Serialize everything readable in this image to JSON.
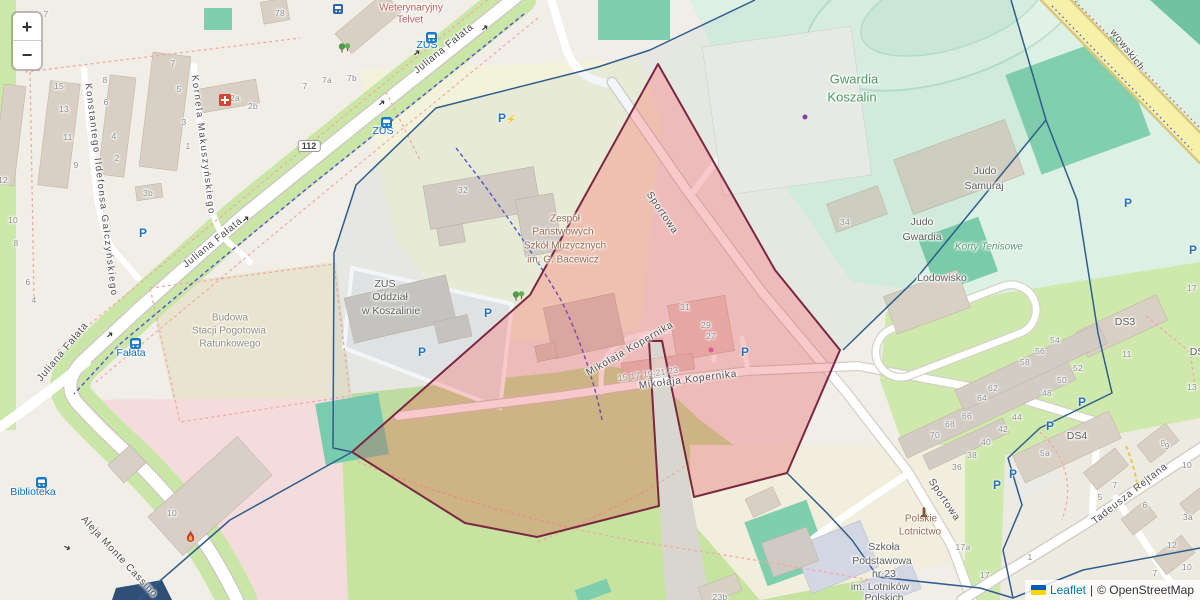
{
  "controls": {
    "zoom_in_label": "+",
    "zoom_out_label": "−"
  },
  "attribution": {
    "leaflet_label": "Leaflet",
    "separator": "|",
    "osm_label": "© OpenStreetMap",
    "leaflet_link_color": "#0078A8",
    "flag_top_color": "#005BBB",
    "flag_bottom_color": "#FFD500"
  },
  "overlay": {
    "red_fill": "rgba(227,54,62,0.27)",
    "red_stroke": "#7c2742",
    "blue_stroke": "#2f5d8c",
    "tint_a_fill": "rgba(100,140,175,0.08)",
    "tint_b_fill": "rgba(110,185,160,0.10)",
    "red_polygon": "658,64 775,270 840,350 787,473 694,497 662,341 649,341 659,506 537,537 465,523 352,452 530,295",
    "tint_a_polygon": "755,0 650,50 598,67 436,108 356,185 334,253 333,448 352,452 530,295 658,64",
    "tint_b_polygon": "755,0 1011,0 1046,120 915,280 843,350 840,350 775,270 658,64",
    "blue_lines": [
      "755,0 650,50 598,67 436,108 356,185 334,253 333,448 352,452",
      "352,452 230,520 138,600",
      "1011,0 1046,120 915,280 843,350",
      "1046,120 1077,200 1098,333 1112,393 1040,428 1008,458 1022,505 1003,550 1013,598",
      "787,473 827,513 852,540 878,577 980,588 1013,598",
      "1013,598 1083,570 1200,548"
    ]
  },
  "road_shield": {
    "label": "112",
    "x": 309,
    "y": 146
  },
  "streets": [
    {
      "label": "Juliana Fałata",
      "x": 444,
      "y": 49,
      "rot": -39,
      "cls": "street"
    },
    {
      "label": "Juliana Fałata",
      "x": 213,
      "y": 243,
      "rot": -39,
      "cls": "street"
    },
    {
      "label": "Juliana Fałata",
      "x": 63,
      "y": 352,
      "rot": -50,
      "cls": "street"
    },
    {
      "label": "Konstantego Ildefonsa Gałczyńskiego",
      "x": 101,
      "y": 190,
      "rot": 83,
      "cls": "street-v"
    },
    {
      "label": "Kornela Makuszyńskiego",
      "x": 203,
      "y": 145,
      "rot": 83,
      "cls": "street-v"
    },
    {
      "label": "Aleja Monte Cassino",
      "x": 119,
      "y": 557,
      "rot": 47,
      "cls": "street"
    },
    {
      "label": "Sportowa",
      "x": 662,
      "y": 213,
      "rot": 56,
      "cls": "street"
    },
    {
      "label": "Sportowa",
      "x": 944,
      "y": 500,
      "rot": 56,
      "cls": "street"
    },
    {
      "label": "Mikołaja Kopernika",
      "x": 630,
      "y": 349,
      "rot": -30,
      "cls": "street"
    },
    {
      "label": "Mikołaja Kopernika",
      "x": 688,
      "y": 380,
      "rot": -7,
      "cls": "street"
    },
    {
      "label": "Tadeusza Rejtana",
      "x": 1130,
      "y": 494,
      "rot": -38,
      "cls": "street"
    },
    {
      "label": "wowskich",
      "x": 1127,
      "y": 50,
      "rot": 52,
      "cls": "street"
    }
  ],
  "pois": [
    {
      "label": "Weterynaryjny",
      "x": 411,
      "y": 8,
      "cls": "vet"
    },
    {
      "label": "Telvet",
      "x": 410,
      "y": 20,
      "cls": "vet"
    },
    {
      "label": "ZUS",
      "x": 427,
      "y": 45,
      "cls": "transit"
    },
    {
      "label": "ZUS",
      "x": 383,
      "y": 131,
      "cls": "transit"
    },
    {
      "label": "Fałata",
      "x": 131,
      "y": 353,
      "cls": "transit"
    },
    {
      "label": "Biblioteka",
      "x": 33,
      "y": 492,
      "cls": "transit"
    },
    {
      "label": "ZUS",
      "x": 385,
      "y": 284,
      "cls": "poi"
    },
    {
      "label": "Oddział",
      "x": 390,
      "y": 297,
      "cls": "poi"
    },
    {
      "label": "w Koszalinie",
      "x": 391,
      "y": 311,
      "cls": "poi"
    },
    {
      "label": "Zespół",
      "x": 565,
      "y": 219,
      "cls": "school"
    },
    {
      "label": "Państwowych",
      "x": 563,
      "y": 232,
      "cls": "school"
    },
    {
      "label": "Szkół Muzycznych",
      "x": 565,
      "y": 246,
      "cls": "school"
    },
    {
      "label": "im. G. Bacewicz",
      "x": 563,
      "y": 260,
      "cls": "school"
    },
    {
      "label": "Budowa",
      "x": 230,
      "y": 318,
      "cls": "constr"
    },
    {
      "label": "Stacji Pogotowia",
      "x": 229,
      "y": 331,
      "cls": "constr"
    },
    {
      "label": "Ratunkowego",
      "x": 230,
      "y": 344,
      "cls": "constr"
    },
    {
      "label": "Gwardia",
      "x": 854,
      "y": 79,
      "cls": "stadium"
    },
    {
      "label": "Koszalin",
      "x": 852,
      "y": 97,
      "cls": "stadium"
    },
    {
      "label": "Judo",
      "x": 985,
      "y": 171,
      "cls": "poi"
    },
    {
      "label": "Samuraj",
      "x": 984,
      "y": 186,
      "cls": "poi"
    },
    {
      "label": "Judo",
      "x": 922,
      "y": 222,
      "cls": "poi"
    },
    {
      "label": "Gwardia",
      "x": 922,
      "y": 237,
      "cls": "poi"
    },
    {
      "label": "Korty Tenisowe",
      "x": 989,
      "y": 247,
      "cls": "pitchlbl"
    },
    {
      "label": "Lodowisko",
      "x": 942,
      "y": 278,
      "cls": "poi"
    },
    {
      "label": "DS3",
      "x": 1125,
      "y": 322,
      "cls": "poi"
    },
    {
      "label": "DS4",
      "x": 1077,
      "y": 436,
      "cls": "poi"
    },
    {
      "label": "DS2",
      "x": 1200,
      "y": 352,
      "cls": "poi"
    },
    {
      "label": "Szkoła",
      "x": 884,
      "y": 547,
      "cls": "poi"
    },
    {
      "label": "Podstawowa",
      "x": 882,
      "y": 561,
      "cls": "poi"
    },
    {
      "label": "nr 23",
      "x": 884,
      "y": 574,
      "cls": "poi"
    },
    {
      "label": "im. Lotników",
      "x": 880,
      "y": 587,
      "cls": "poi"
    },
    {
      "label": "Polskich",
      "x": 884,
      "y": 598,
      "cls": "poi"
    },
    {
      "label": "Polskie",
      "x": 921,
      "y": 519,
      "cls": "school"
    },
    {
      "label": "Lotnictwo",
      "x": 920,
      "y": 532,
      "cls": "school"
    }
  ],
  "numbers": [
    {
      "label": "7",
      "x": 46,
      "y": 14
    },
    {
      "label": "78",
      "x": 280,
      "y": 13
    },
    {
      "label": "15",
      "x": 59,
      "y": 86
    },
    {
      "label": "13",
      "x": 64,
      "y": 109
    },
    {
      "label": "11",
      "x": 68,
      "y": 137
    },
    {
      "label": "9",
      "x": 76,
      "y": 165
    },
    {
      "label": "8",
      "x": 105,
      "y": 80
    },
    {
      "label": "6",
      "x": 106,
      "y": 102
    },
    {
      "label": "4",
      "x": 114,
      "y": 136
    },
    {
      "label": "2",
      "x": 117,
      "y": 158
    },
    {
      "label": "7",
      "x": 173,
      "y": 63
    },
    {
      "label": "5",
      "x": 179,
      "y": 89
    },
    {
      "label": "3",
      "x": 184,
      "y": 122
    },
    {
      "label": "1",
      "x": 188,
      "y": 146
    },
    {
      "label": "2a",
      "x": 235,
      "y": 98
    },
    {
      "label": "2b",
      "x": 253,
      "y": 106
    },
    {
      "label": "3b",
      "x": 148,
      "y": 193
    },
    {
      "label": "7",
      "x": 305,
      "y": 86
    },
    {
      "label": "7a",
      "x": 327,
      "y": 80
    },
    {
      "label": "7b",
      "x": 352,
      "y": 78
    },
    {
      "label": "12",
      "x": 3,
      "y": 180
    },
    {
      "label": "10",
      "x": 13,
      "y": 220
    },
    {
      "label": "8",
      "x": 16,
      "y": 243
    },
    {
      "label": "6",
      "x": 28,
      "y": 282
    },
    {
      "label": "4",
      "x": 34,
      "y": 300
    },
    {
      "label": "32",
      "x": 463,
      "y": 190
    },
    {
      "label": "34",
      "x": 845,
      "y": 222
    },
    {
      "label": "31",
      "x": 685,
      "y": 307
    },
    {
      "label": "29",
      "x": 706,
      "y": 325
    },
    {
      "label": "27",
      "x": 711,
      "y": 336
    },
    {
      "label": "15 17 19 21 23",
      "x": 648,
      "y": 374,
      "rot": -8
    },
    {
      "label": "10",
      "x": 172,
      "y": 513
    },
    {
      "label": "17",
      "x": 1192,
      "y": 288
    },
    {
      "label": "11",
      "x": 1127,
      "y": 354
    },
    {
      "label": "13",
      "x": 1192,
      "y": 387
    },
    {
      "label": "54",
      "x": 1055,
      "y": 340
    },
    {
      "label": "56",
      "x": 1040,
      "y": 351
    },
    {
      "label": "58",
      "x": 1025,
      "y": 362
    },
    {
      "label": "52",
      "x": 1078,
      "y": 368
    },
    {
      "label": "50",
      "x": 1062,
      "y": 380
    },
    {
      "label": "62",
      "x": 993,
      "y": 388
    },
    {
      "label": "48",
      "x": 1047,
      "y": 393
    },
    {
      "label": "64",
      "x": 982,
      "y": 398
    },
    {
      "label": "44",
      "x": 1017,
      "y": 417
    },
    {
      "label": "66",
      "x": 967,
      "y": 416
    },
    {
      "label": "42",
      "x": 1003,
      "y": 429
    },
    {
      "label": "68",
      "x": 950,
      "y": 424
    },
    {
      "label": "40",
      "x": 986,
      "y": 442
    },
    {
      "label": "70",
      "x": 935,
      "y": 435
    },
    {
      "label": "38",
      "x": 972,
      "y": 455
    },
    {
      "label": "36",
      "x": 957,
      "y": 467
    },
    {
      "label": "5a",
      "x": 1045,
      "y": 453
    },
    {
      "label": "3a",
      "x": 1188,
      "y": 517
    },
    {
      "label": "1",
      "x": 1030,
      "y": 557
    },
    {
      "label": "17a",
      "x": 963,
      "y": 547
    },
    {
      "label": "17",
      "x": 985,
      "y": 575
    },
    {
      "label": "23b",
      "x": 720,
      "y": 597
    },
    {
      "label": "9",
      "x": 1163,
      "y": 443
    },
    {
      "label": "10",
      "x": 1187,
      "y": 465
    },
    {
      "label": "5",
      "x": 1100,
      "y": 497
    },
    {
      "label": "7",
      "x": 1115,
      "y": 485
    },
    {
      "label": "6",
      "x": 1145,
      "y": 505
    },
    {
      "label": "12",
      "x": 1172,
      "y": 545
    },
    {
      "label": "10",
      "x": 1187,
      "y": 567
    },
    {
      "label": "7",
      "x": 1155,
      "y": 573
    },
    {
      "label": "9",
      "x": 1167,
      "y": 446
    }
  ],
  "icons": [
    {
      "type": "bus-stop",
      "x": 426,
      "y": 32
    },
    {
      "type": "bus-stop",
      "x": 381,
      "y": 117
    },
    {
      "type": "bus-stop",
      "x": 130,
      "y": 338
    },
    {
      "type": "bus-stop",
      "x": 36,
      "y": 477
    },
    {
      "type": "rail",
      "x": 333,
      "y": 4
    },
    {
      "type": "parking",
      "x": 143,
      "y": 233
    },
    {
      "type": "parking",
      "x": 488,
      "y": 313
    },
    {
      "type": "parking",
      "x": 422,
      "y": 352
    },
    {
      "type": "parking",
      "x": 745,
      "y": 352
    },
    {
      "type": "parking",
      "x": 1128,
      "y": 203
    },
    {
      "type": "parking",
      "x": 1193,
      "y": 250
    },
    {
      "type": "parking",
      "x": 1082,
      "y": 402
    },
    {
      "type": "parking",
      "x": 1050,
      "y": 426
    },
    {
      "type": "parking",
      "x": 1013,
      "y": 474
    },
    {
      "type": "parking",
      "x": 997,
      "y": 485
    },
    {
      "type": "parking-ev",
      "x": 507,
      "y": 118
    },
    {
      "type": "medical-cross",
      "x": 219,
      "y": 94
    },
    {
      "type": "flame",
      "x": 185,
      "y": 530
    },
    {
      "type": "monument",
      "x": 919,
      "y": 507
    },
    {
      "type": "dot-purple",
      "x": 805,
      "y": 117
    },
    {
      "type": "dot-pink",
      "x": 711,
      "y": 350
    },
    {
      "type": "trees",
      "x": 338,
      "y": 42
    },
    {
      "type": "trees",
      "x": 512,
      "y": 290
    },
    {
      "type": "arrow",
      "x": 485,
      "y": 28,
      "rot": -39
    },
    {
      "type": "arrow",
      "x": 417,
      "y": 53,
      "rot": -39
    },
    {
      "type": "arrow",
      "x": 382,
      "y": 103,
      "rot": -39
    },
    {
      "type": "arrow",
      "x": 246,
      "y": 219,
      "rot": -39
    },
    {
      "type": "arrow",
      "x": 110,
      "y": 335,
      "rot": -39
    },
    {
      "type": "arrow",
      "x": 67,
      "y": 548,
      "rot": 25
    }
  ]
}
